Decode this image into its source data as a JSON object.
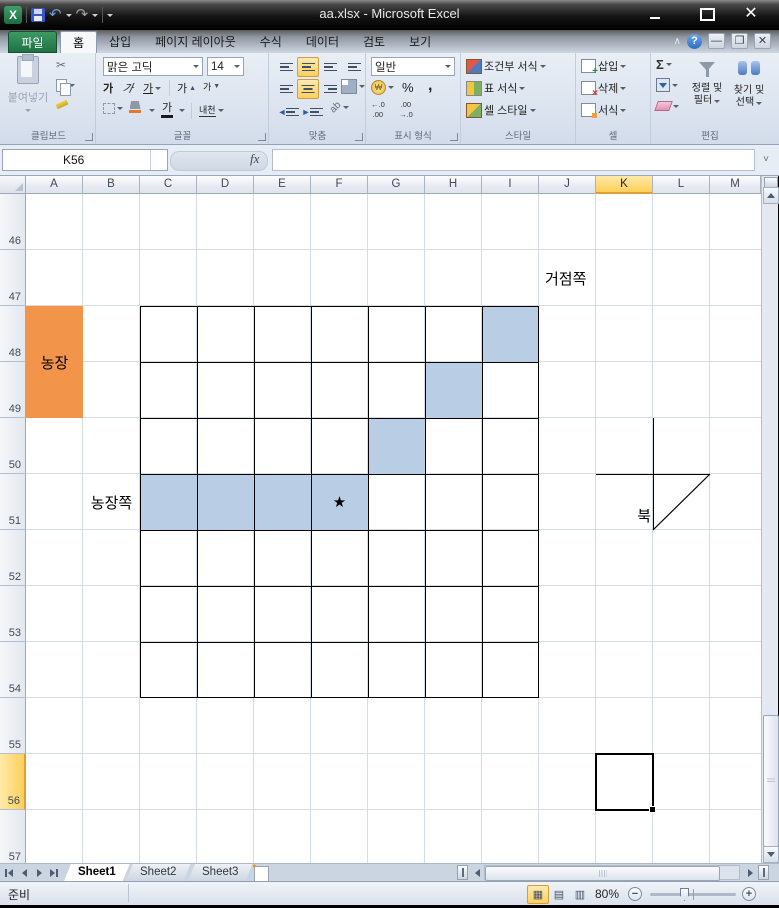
{
  "window": {
    "title": "aa.xlsx - Microsoft Excel"
  },
  "ribbon": {
    "file_tab": "파일",
    "tabs": [
      "홈",
      "삽입",
      "페이지 레이아웃",
      "수식",
      "데이터",
      "검토",
      "보기"
    ],
    "active_tab": "홈",
    "clipboard": {
      "label": "클립보드",
      "paste": "붙여넣기"
    },
    "font": {
      "label": "글꼴",
      "name": "맑은 고딕",
      "size": "14",
      "bold": "가",
      "italic": "가",
      "underline": "가",
      "grow": "가",
      "shrink": "가",
      "phonetic": "내천"
    },
    "alignment": {
      "label": "맞춤"
    },
    "number": {
      "label": "표시 형식",
      "format": "일반",
      "percent": "%",
      "comma": ",",
      "inc_decimal": [
        "←.0",
        ".00"
      ],
      "dec_decimal": [
        ".00",
        "→.0"
      ]
    },
    "styles": {
      "label": "스타일",
      "items": [
        "조건부 서식",
        "표 서식",
        "셀 스타일"
      ]
    },
    "cells": {
      "label": "셀",
      "items": [
        "삽입",
        "삭제",
        "서식"
      ]
    },
    "editing": {
      "label": "편집",
      "autosum": "Σ",
      "sort_filter": [
        "정렬 및",
        "필터"
      ],
      "find_select": [
        "찾기 및",
        "선택"
      ]
    }
  },
  "formula_bar": {
    "name_box": "K56",
    "fx": "fx",
    "value": ""
  },
  "sheet": {
    "columns": [
      "A",
      "B",
      "C",
      "D",
      "E",
      "F",
      "G",
      "H",
      "I",
      "J",
      "K",
      "L",
      "M"
    ],
    "rows": [
      "46",
      "47",
      "48",
      "49",
      "50",
      "51",
      "52",
      "53",
      "54",
      "55",
      "56",
      "57"
    ],
    "selected_column": "K",
    "selected_row": "56",
    "selected_cell": "K56",
    "colors": {
      "blue_fill": "#b9cde5",
      "orange_fill": "#f2944a",
      "gridline": "#d5dce6"
    },
    "bordered_range": "C48:I54",
    "blue_cells": [
      "I48",
      "H49",
      "G50",
      "C51",
      "D51",
      "E51",
      "F51"
    ],
    "merged_orange": {
      "range": "A48:A49",
      "text": "농장"
    },
    "texts": [
      {
        "cell": "J47",
        "text": "거점쪽",
        "align": "left"
      },
      {
        "cell": "B51",
        "text": "농장쪽",
        "align": "center"
      },
      {
        "cell": "F51",
        "text": "★",
        "align": "center"
      }
    ],
    "north_marker": {
      "label": "북",
      "vline": {
        "x": 653,
        "y1": 418,
        "y2": 530
      },
      "hline": {
        "y": 474,
        "x1": 596,
        "x2": 710
      },
      "diagonal": {
        "x1": 710,
        "y1": 474,
        "x2": 653,
        "y2": 530
      }
    }
  },
  "sheet_tabs": {
    "items": [
      "Sheet1",
      "Sheet2",
      "Sheet3"
    ],
    "active": "Sheet1"
  },
  "status_bar": {
    "ready": "준비",
    "zoom": "80%"
  }
}
